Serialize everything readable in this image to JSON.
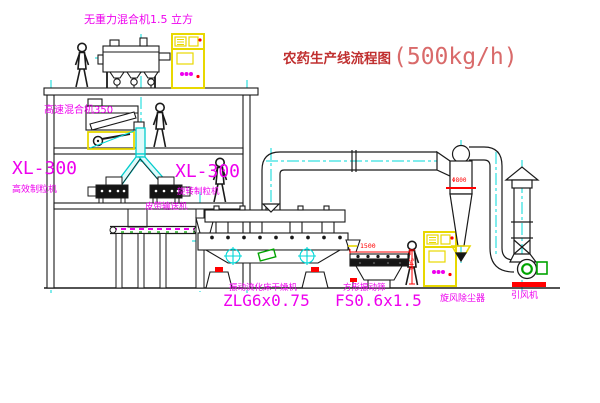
{
  "title": {
    "name": "农药生产线流程图",
    "capacity": "(500kg/h)"
  },
  "labels": {
    "gravity_mixer": "无重力混合机1.5 立方",
    "high_speed_mixer": "高速混合机350",
    "granulator_left_model": "XL-300",
    "granulator_left_name": "高效制粒机",
    "granulator_right_model": "XL-300",
    "granulator_right_name": "旋转制粒机",
    "belt_conveyor": "皮带输送机",
    "dryer_name": "振动流化床干燥机",
    "dryer_model": "ZLG6x0.75",
    "screen_name": "方形振动筛",
    "screen_model": "FS0.6x1.5",
    "cyclone": "旋风除尘器",
    "fan": "引风机"
  },
  "dims": {
    "screen_length": "1500",
    "screen_height": "540",
    "cyclone_dia": "Φ800"
  },
  "colors": {
    "label_magenta": "#ee00ee",
    "title_dark_red": "#c03030",
    "title_light_red": "#d96a6a",
    "centerline_cyan": "#00d8d8",
    "cabinet_yellow": "#e8d800",
    "dimension_red": "#ff0000",
    "fan_green": "#00a400",
    "line_black": "#1a1a1a",
    "background": "#ffffff"
  }
}
